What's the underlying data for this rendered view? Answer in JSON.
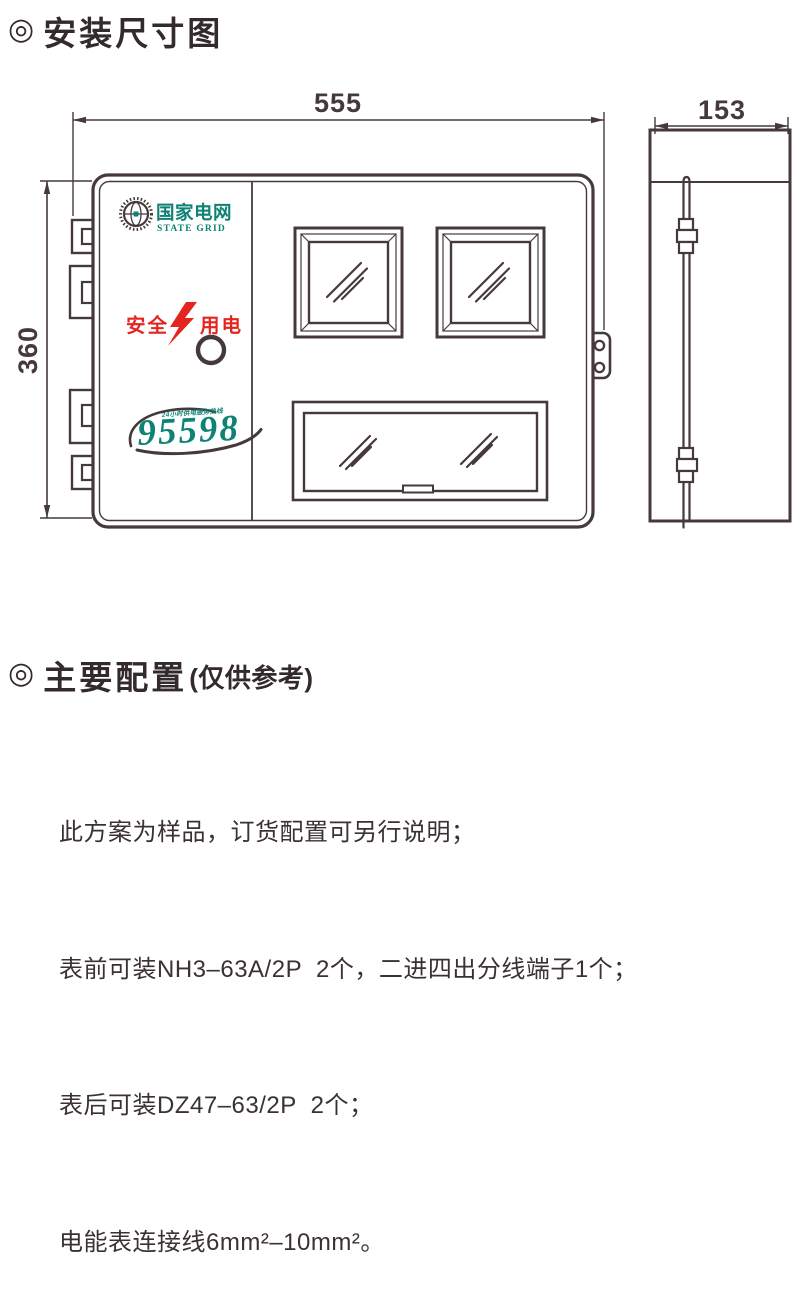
{
  "colors": {
    "brand": "#0e8274",
    "red": "#e52420",
    "line": "#45393b",
    "ink": "#322a2c"
  },
  "section_dimension": {
    "bullet": "◎",
    "title": "安装尺寸图"
  },
  "diagram": {
    "dim_width": "555",
    "dim_height": "360",
    "dim_depth": "153",
    "brand_cn": "国家电网",
    "brand_en": "STATE GRID",
    "safety_left": "安全",
    "safety_right": "用电",
    "hotline_number": "95598",
    "hotline_caption": "24小时供电服务热线"
  },
  "section_config": {
    "bullet": "◎",
    "title": "主要配置",
    "title_suffix": "(仅供参考)",
    "lines": [
      "此方案为样品，订货配置可另行说明；",
      "表前可装NH3–63A/2P  2个，二进四出分线端子1个；",
      "表后可装DZ47–63/2P  2个；",
      "电能表连接线6mm²–10mm²。"
    ]
  }
}
